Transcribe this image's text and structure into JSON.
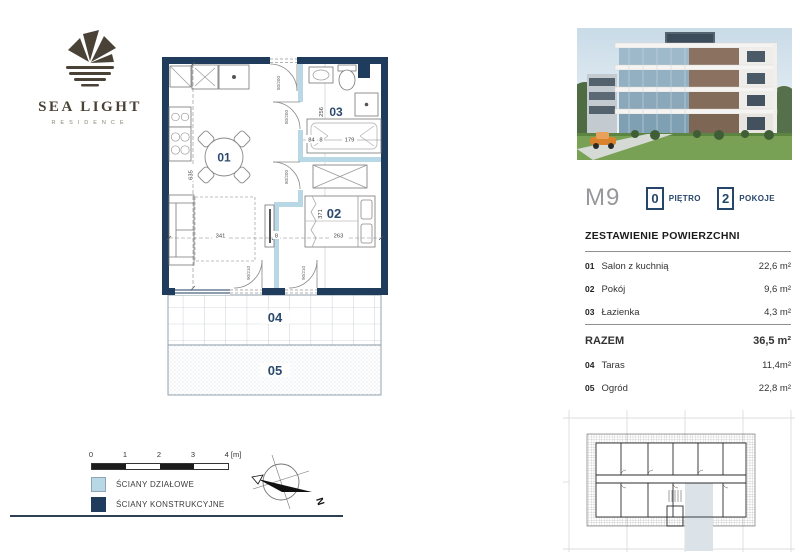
{
  "logo": {
    "title": "SEA LIGHT",
    "subtitle": "RESIDENCE"
  },
  "unit": {
    "code": "M9",
    "floor": {
      "value": "0",
      "label": "PIĘTRO"
    },
    "rooms": {
      "value": "2",
      "label": "POKOJE"
    }
  },
  "areas": {
    "title": "ZESTAWIENIE POWIERZCHNI",
    "rows": [
      {
        "no": "01",
        "name": "Salon z kuchnią",
        "area": "22,6 m²"
      },
      {
        "no": "02",
        "name": "Pokój",
        "area": "9,6 m²"
      },
      {
        "no": "03",
        "name": "Łazienka",
        "area": "4,3 m²"
      }
    ],
    "total": {
      "label": "RAZEM",
      "area": "36,5 m²"
    },
    "outdoor": [
      {
        "no": "04",
        "name": "Taras",
        "area": "11,4m²"
      },
      {
        "no": "05",
        "name": "Ogród",
        "area": "22,8 m²"
      }
    ]
  },
  "plan": {
    "rooms": {
      "r01": "01",
      "r02": "02",
      "r03": "03",
      "r04": "04",
      "r05": "05"
    },
    "dims": {
      "d341": "341",
      "d8a": "8",
      "d263": "263",
      "d635": "635",
      "d371": "371",
      "d256": "256",
      "d84": "84",
      "d8b": "8",
      "d179": "179"
    },
    "doors": {
      "entrance": "80/200",
      "bath": "80/200",
      "room": "80/200",
      "terrace1": "90/210",
      "terrace2": "90/210"
    }
  },
  "scalebar": {
    "t0": "0",
    "t1": "1",
    "t2": "2",
    "t3": "3",
    "t4": "4 [m]"
  },
  "legend": {
    "partition": "ŚCIANY DZIAŁOWE",
    "structural": "ŚCIANY KONSTRUKCYJNE"
  },
  "compass": {
    "north": "N"
  },
  "colors": {
    "wall_structural": "#1f3c5c",
    "wall_partition": "#b9d8e6",
    "label_navy": "#2b4a6e",
    "unit_gray": "#96989b",
    "keyplan_highlight": "#dce3e8"
  }
}
